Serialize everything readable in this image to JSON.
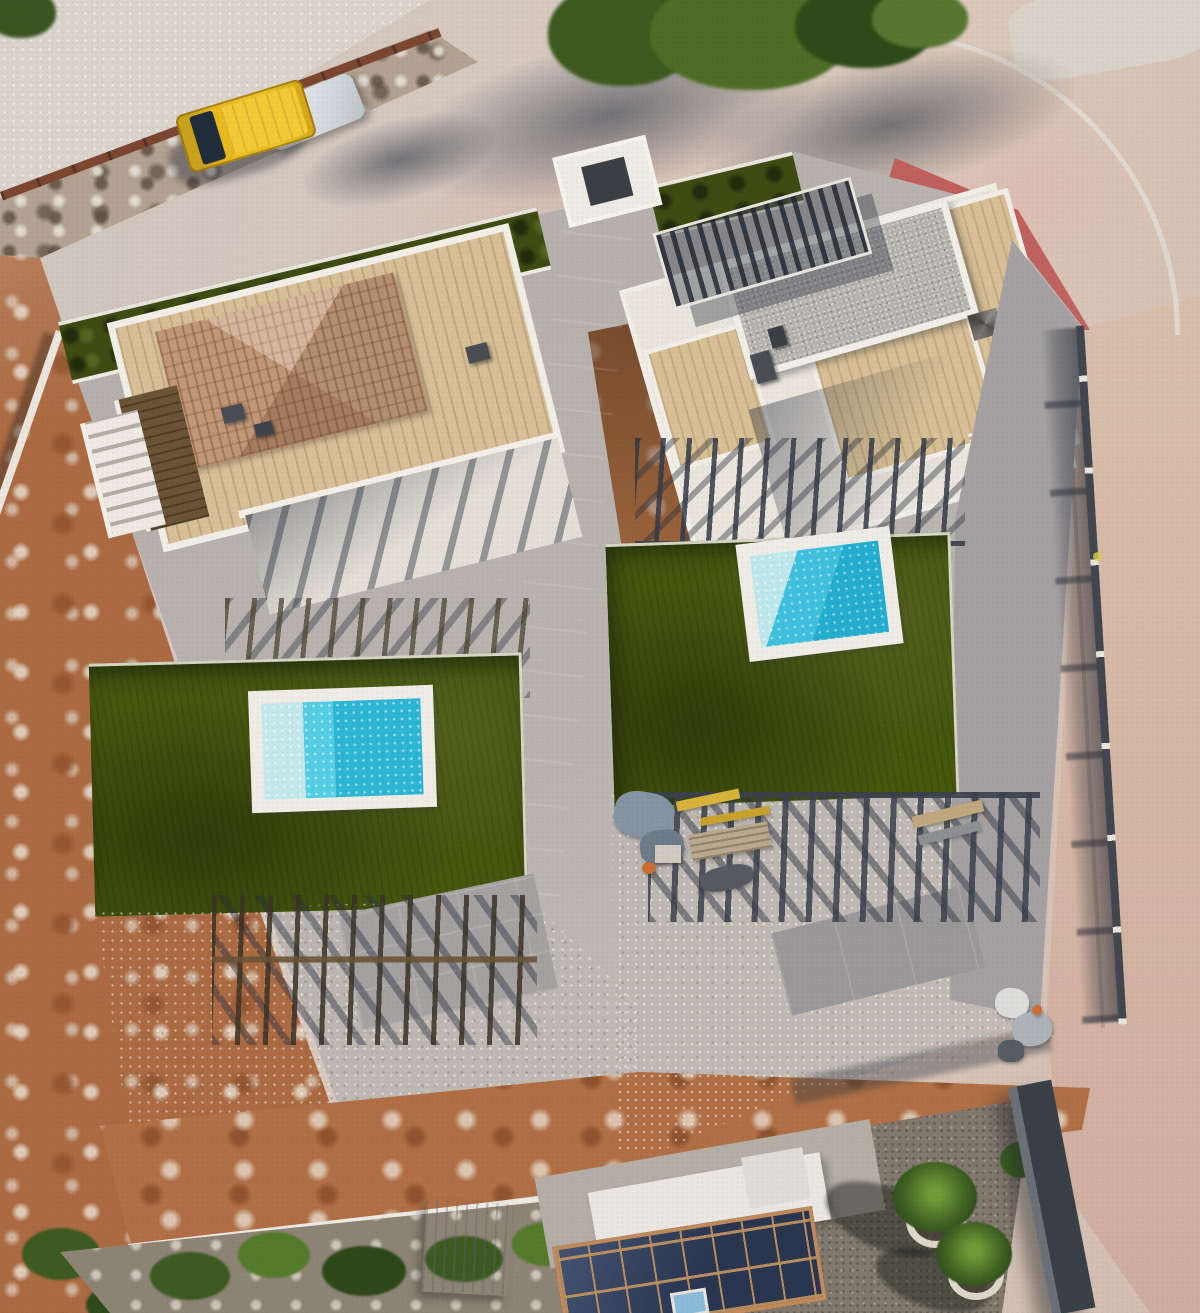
{
  "meta": {
    "description": "Top-down aerial drone photograph of two newly built white villas with artificial turf lawns and turquoise swimming pools, surrounded by roads, a parked yellow van, vacant dirt lots and a neighbouring house with rooftop solar panels",
    "image_type": "aerial-photograph"
  },
  "palette": {
    "road_concrete": "#d2c4ba",
    "side_road_sand": "#d5b8a6",
    "red_paving": "#bf5c5a",
    "curb_white": "#e0d8ce",
    "plot_concrete": "#b2adab",
    "driveway_light": "#d9d2c8",
    "turf_green": "#47580f",
    "hedge_green": "#3e4c14",
    "pool_deep": "#2db5d6",
    "pool_mid": "#55cde4",
    "pool_shallow": "#c3e9ec",
    "pool_rim": "#efece5",
    "villa_white": "#f1eee8",
    "wood_deck": "#d8c096",
    "dark_wood_deck": "#6a5336",
    "tile_roof": "#c89e7c",
    "gravel_roof": "#b6b2ae",
    "dirt_orange": "#ab6a42",
    "steel_pergola": "#3a414d",
    "shadow_blue": "#2a3040",
    "tree_green": "#4e6d26",
    "van_yellow": "#e8b81f",
    "van_glass": "#222d3a",
    "solar_panel": "#2a3650",
    "terracotta": "#c08a5a",
    "neighbor_gravel": "#82796e",
    "shed_metal": "#c8cdd1",
    "tarp_white": "#eef0f2",
    "rust_railing": "#7c4631",
    "rock_wall": "#b3a291",
    "palm_green": "#3f6223",
    "dark_wall": "#3a4047"
  },
  "scene": {
    "objects": [
      {
        "name": "street-top",
        "desc": "diagonal street running along the upper edge with tree shadows"
      },
      {
        "name": "yellow-van",
        "desc": "yellow delivery van parked on the street"
      },
      {
        "name": "street-trees",
        "desc": "green tree canopies overhanging the street"
      },
      {
        "name": "red-paving-patch",
        "desc": "red painted paving at the street corner"
      },
      {
        "name": "side-road",
        "desc": "sandy side road along the right edge"
      },
      {
        "name": "villa-a",
        "desc": "left villa with terracotta hip tile roof and wooden roof deck"
      },
      {
        "name": "villa-b",
        "desc": "right villa with gravel flat roof and wooden roof terrace"
      },
      {
        "name": "pool-a",
        "desc": "left plunge pool, turquoise with shallow step"
      },
      {
        "name": "pool-b",
        "desc": "right plunge pool, turquoise with shallow step"
      },
      {
        "name": "lawn-a",
        "desc": "left artificial turf lawn"
      },
      {
        "name": "lawn-b",
        "desc": "right artificial turf lawn"
      },
      {
        "name": "pergola-fences",
        "desc": "dark steel pergolas and fences casting striped shadows"
      },
      {
        "name": "construction-materials",
        "desc": "tarps, beams, bricks and tools on the right driveway"
      },
      {
        "name": "vacant-lot",
        "desc": "orange dirt vacant lot on the left"
      },
      {
        "name": "neighbor-house",
        "desc": "neighbouring house with solar panel roof and skylight"
      },
      {
        "name": "metal-shed",
        "desc": "small metal shed"
      },
      {
        "name": "palm-trees",
        "desc": "palm trees with white stone rings in gravel yard"
      },
      {
        "name": "boundary-walls",
        "desc": "white capped boundary walls and mesh fences"
      }
    ]
  }
}
